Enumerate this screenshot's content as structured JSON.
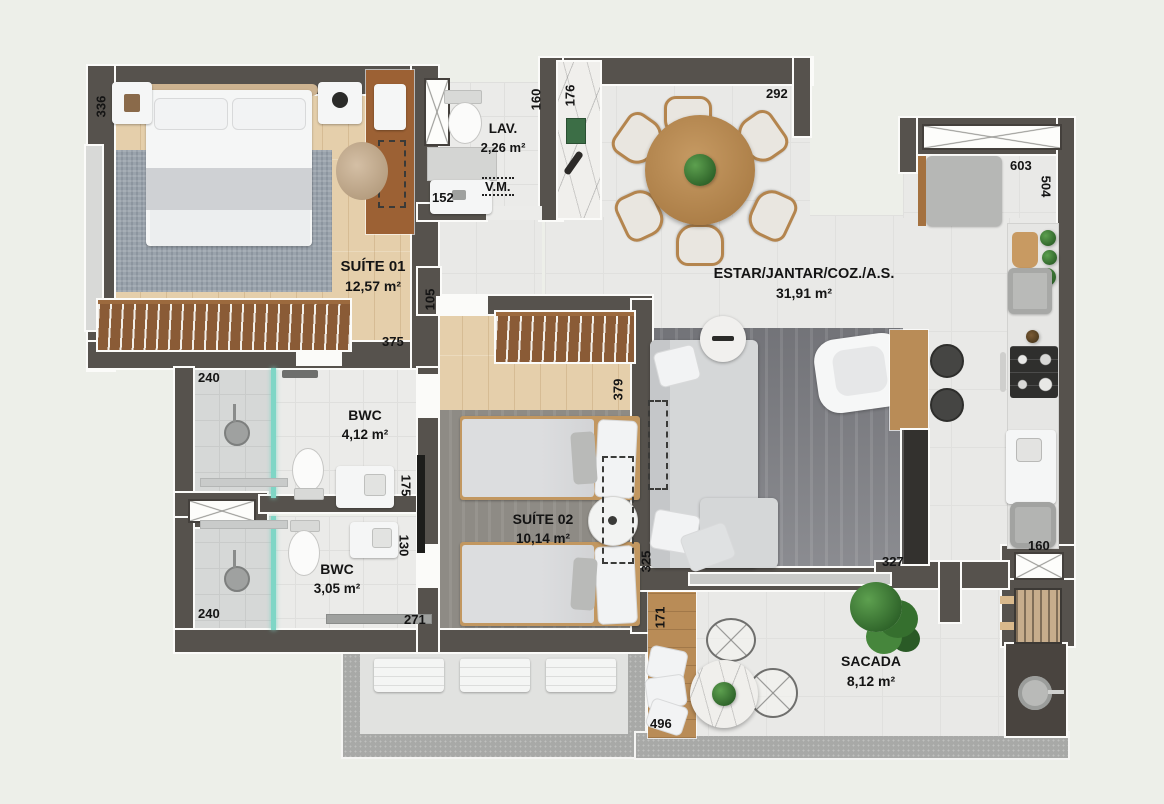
{
  "rooms": {
    "suite01": {
      "name": "SUÍTE 01",
      "area": "12,57 m²"
    },
    "lav": {
      "name": "LAV.",
      "area": "2,26 m²"
    },
    "vm": {
      "name": "V.M."
    },
    "bwc1": {
      "name": "BWC",
      "area": "4,12 m²"
    },
    "bwc2": {
      "name": "BWC",
      "area": "3,05 m²"
    },
    "suite02": {
      "name": "SUÍTE 02",
      "area": "10,14 m²"
    },
    "living": {
      "name": "ESTAR/JANTAR/COZ./A.S.",
      "area": "31,91 m²"
    },
    "sacada": {
      "name": "SACADA",
      "area": "8,12 m²"
    }
  },
  "dims": {
    "suite01_336": "336",
    "hall_160": "160",
    "entry_176": "176",
    "living_292": "292",
    "lav_152": "152",
    "kitchen_603": "603",
    "kitchen_504": "504",
    "step_105": "105",
    "door_375": "375",
    "bwc1_240": "240",
    "bwc1_175": "175",
    "bwc2_130": "130",
    "bwc2_240": "240",
    "bwc2_271": "271",
    "suite02_379": "379",
    "sacada_325": "325",
    "sacada_327": "327",
    "sacada_171": "171",
    "sacada_496": "496",
    "as_160": "160"
  },
  "colors": {
    "wall": "#56524d",
    "wood_floor": "#e5cfab",
    "closet_wood": "#8a5b36",
    "furniture_wood": "#b98c57",
    "shower_glass": "#7fd6c6",
    "plant_green": "#3f7c38"
  }
}
